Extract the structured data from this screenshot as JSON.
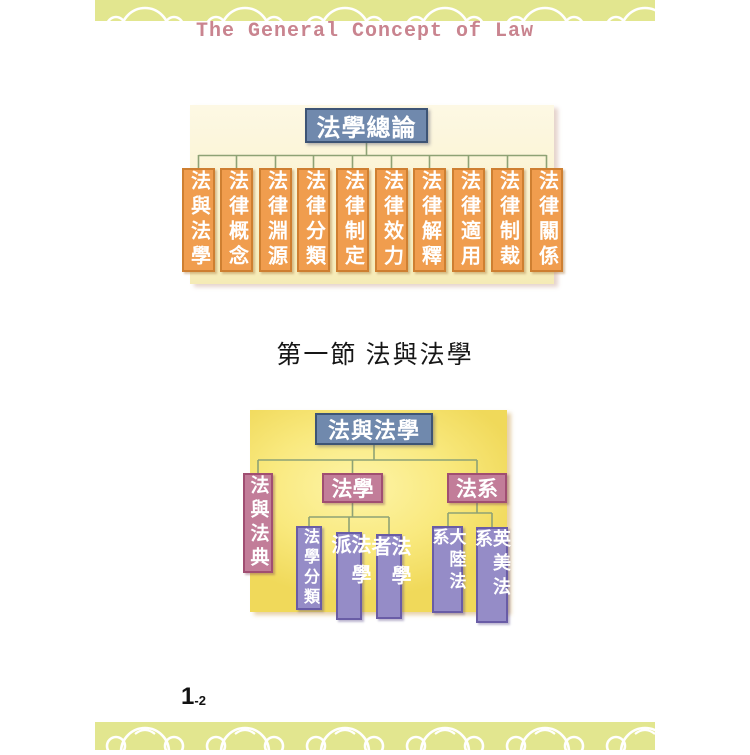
{
  "header": {
    "title": "The General Concept of Law",
    "title_color": "#c9848f",
    "band_color": "#e2e68f",
    "band_pattern": "white monkey-cloud outlines"
  },
  "diagram1": {
    "title": "法學總論",
    "children": [
      "法與法學",
      "法律概念",
      "法律淵源",
      "法律分類",
      "法律制定",
      "法律效力",
      "法律解釋",
      "法律適用",
      "法律制裁",
      "法律關係"
    ],
    "colors": {
      "root_fill": "#7089ad",
      "root_border": "#3d5475",
      "child_fill": "#f09d4e",
      "child_border": "#ce7f31",
      "panel": "#faf2cc",
      "connector": "#8ea275"
    }
  },
  "section": {
    "heading": "第一節 法與法學"
  },
  "diagram2": {
    "title": "法與法學",
    "branches": [
      {
        "label": "法與法典",
        "children": []
      },
      {
        "label": "法學",
        "children": [
          "法學分類",
          "法學派",
          "法學者"
        ]
      },
      {
        "label": "法系",
        "children": [
          "大陸法系",
          "英美法系"
        ]
      }
    ],
    "colors": {
      "root_fill": "#7089ad",
      "root_border": "#3d5475",
      "branch_fill": "#c27d99",
      "branch_border": "#a04e72",
      "leaf_fill": "#958cc7",
      "leaf_border": "#695ca6",
      "panel": "#f8e878",
      "connector": "#8ea275"
    }
  },
  "footer": {
    "page_number_major": "1",
    "page_number_minor": "-2"
  }
}
